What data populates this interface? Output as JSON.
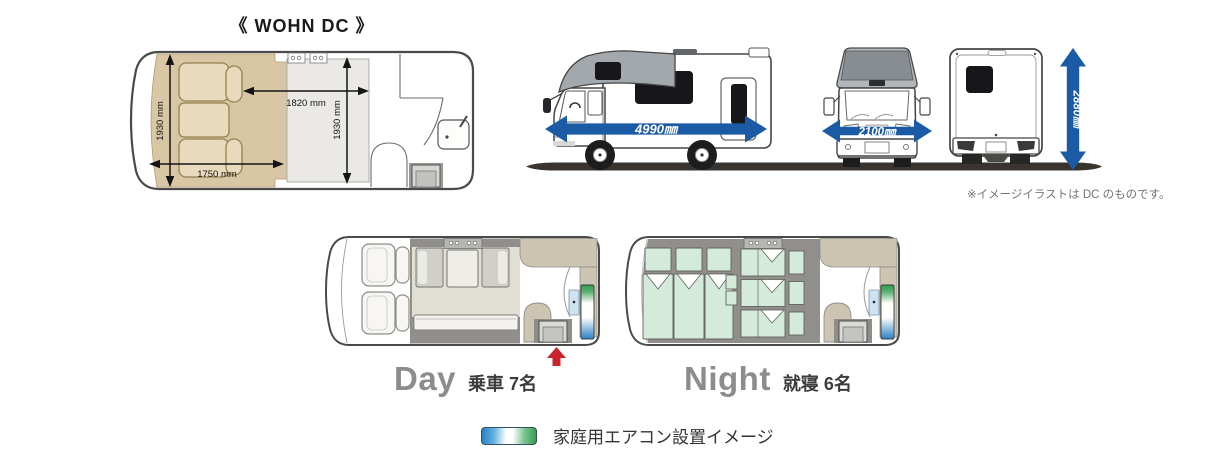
{
  "title": "《 WOHN DC 》",
  "floor_plan": {
    "bed_width": "1930 mm",
    "bed_length": "1750 mm",
    "room_length": "1820 mm",
    "room_width": "1930 mm"
  },
  "exterior": {
    "length": "4990㎜",
    "width": "2100㎜",
    "height": "2880㎜",
    "note": "※イメージイラストは DC のものです。"
  },
  "layouts": {
    "day": {
      "label": "Day",
      "caption": "乗車 7名"
    },
    "night": {
      "label": "Night",
      "caption": "就寝 6名"
    }
  },
  "legend": {
    "label": "家庭用エアコン設置イメージ"
  },
  "colors": {
    "dimension_arrow_blue": "#1b5aa5",
    "bed_beige": "#d9c6a4",
    "night_bed_mint": "#d4ebdb",
    "interior_gray": "#908f8b",
    "entry_arrow_red": "#c9252c",
    "ac_gradient_green": "#2f9e4f",
    "ac_gradient_blue": "#2b7fc4"
  }
}
